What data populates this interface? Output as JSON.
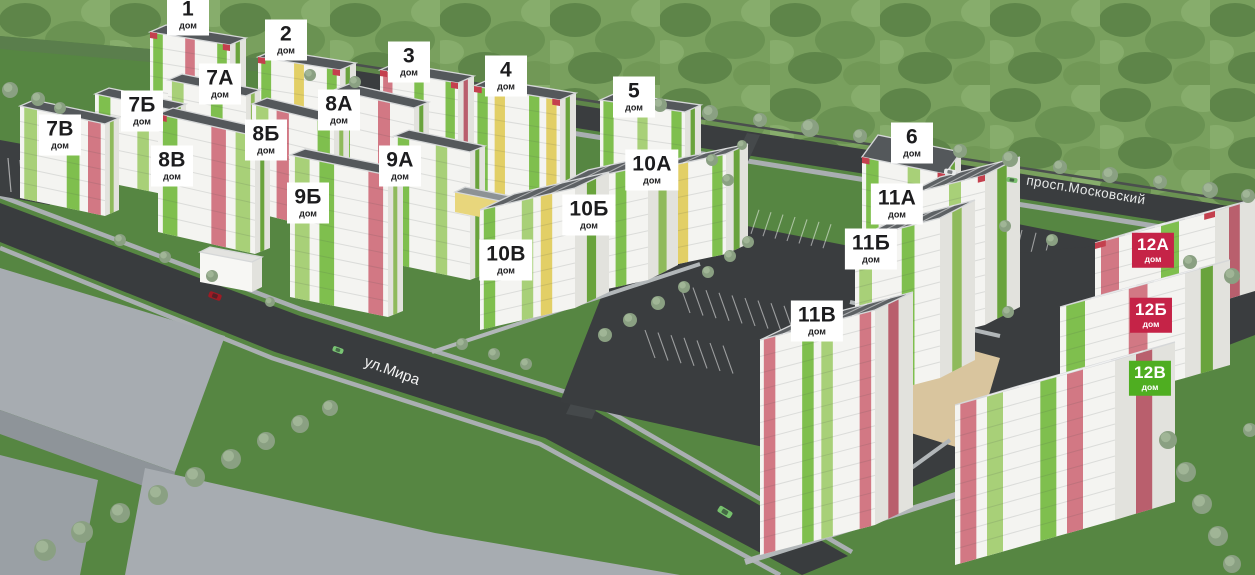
{
  "streets": [
    {
      "name": "ул.Мира",
      "cx": 392,
      "cy": 371,
      "angle": 20
    },
    {
      "name": "просп.Московский",
      "cx": 1086,
      "cy": 190,
      "angle": 9.5
    }
  ],
  "label_sub": "дом",
  "buildings": [
    {
      "id": "1",
      "cx": 188,
      "cy": 15,
      "variant": "white"
    },
    {
      "id": "2",
      "cx": 286,
      "cy": 40,
      "variant": "white"
    },
    {
      "id": "3",
      "cx": 409,
      "cy": 62,
      "variant": "white"
    },
    {
      "id": "4",
      "cx": 506,
      "cy": 76,
      "variant": "white"
    },
    {
      "id": "5",
      "cx": 634,
      "cy": 97,
      "variant": "white"
    },
    {
      "id": "6",
      "cx": 912,
      "cy": 143,
      "variant": "white"
    },
    {
      "id": "7А",
      "cx": 220,
      "cy": 84,
      "variant": "white"
    },
    {
      "id": "7Б",
      "cx": 142,
      "cy": 111,
      "variant": "white"
    },
    {
      "id": "7В",
      "cx": 60,
      "cy": 135,
      "variant": "white"
    },
    {
      "id": "8А",
      "cx": 339,
      "cy": 110,
      "variant": "white"
    },
    {
      "id": "8Б",
      "cx": 266,
      "cy": 140,
      "variant": "white"
    },
    {
      "id": "8В",
      "cx": 172,
      "cy": 166,
      "variant": "white"
    },
    {
      "id": "9А",
      "cx": 400,
      "cy": 166,
      "variant": "white"
    },
    {
      "id": "9Б",
      "cx": 308,
      "cy": 203,
      "variant": "white"
    },
    {
      "id": "10А",
      "cx": 652,
      "cy": 170,
      "variant": "white"
    },
    {
      "id": "10Б",
      "cx": 589,
      "cy": 215,
      "variant": "white"
    },
    {
      "id": "10В",
      "cx": 506,
      "cy": 260,
      "variant": "white"
    },
    {
      "id": "11А",
      "cx": 897,
      "cy": 204,
      "variant": "white"
    },
    {
      "id": "11Б",
      "cx": 871,
      "cy": 249,
      "variant": "white"
    },
    {
      "id": "11В",
      "cx": 817,
      "cy": 321,
      "variant": "white"
    },
    {
      "id": "12А",
      "cx": 1153,
      "cy": 250,
      "variant": "red"
    },
    {
      "id": "12Б",
      "cx": 1151,
      "cy": 315,
      "variant": "red"
    },
    {
      "id": "12В",
      "cx": 1150,
      "cy": 378,
      "variant": "green"
    }
  ],
  "colors": {
    "label_white_bg": "#ffffff",
    "label_text": "#1c1c1e",
    "label_red_bg": "#c52347",
    "label_green_bg": "#4fae21",
    "label_light_text": "#ffffff"
  }
}
